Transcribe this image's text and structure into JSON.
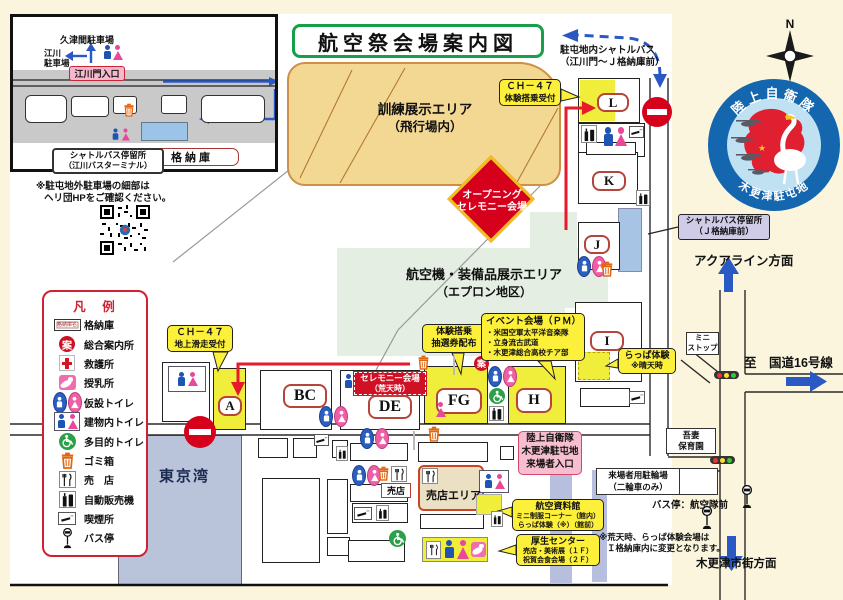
{
  "title": "航空祭会場案内図",
  "inset": {
    "title": "江川門周辺",
    "kutsuma_parking": "久津間駐車場",
    "egawa_parking_1": "江川",
    "egawa_parking_2": "駐車場",
    "gate_entrance": "江川門入口",
    "hangar_label": "格納庫",
    "shuttle_stop_1": "シャトルバス停留所",
    "shuttle_stop_2": "（江川バスターミナル）",
    "note_1": "※駐屯地外駐車場の細部は",
    "note_2": "ヘリ団HPをご確認ください。"
  },
  "compass": {
    "north": "N"
  },
  "emblem": {
    "top": "陸上自衛隊",
    "bottom": "木更津駐屯地"
  },
  "shuttle_note": {
    "line1": "駐屯地内シャトルバス",
    "line2": "（江川門～Ｊ格納庫前）"
  },
  "areas": {
    "training_1": "訓練展示エリア",
    "training_2": "（飛行場内）",
    "apron_1": "航空機・装備品展示エリア",
    "apron_2": "（エプロン地区）",
    "opening_1": "オープニング",
    "opening_2": "セレモニー会場",
    "tokyo_bay": "東京湾",
    "shop_area": "売店エリア",
    "shop_small": "売店"
  },
  "buildings": {
    "a": "A",
    "bc": "BC",
    "de": "DE",
    "fg": "FG",
    "h": "H",
    "i": "I",
    "j": "J",
    "k": "K",
    "l": "L"
  },
  "callouts": {
    "ch47_ride_1": "ＣＨ－４７",
    "ch47_ride_2": "体験搭乗受付",
    "ch47_taxi_1": "ＣＨ－４７",
    "ch47_taxi_2": "地上滑走受付",
    "lottery_1": "体験搭乗",
    "lottery_2": "抽選券配布",
    "event_title": "イベント会場（ＰＭ）",
    "event_1": "・米国空軍太平洋音楽隊",
    "event_2": "・立身流古武道",
    "event_3": "・木更津総合高校チア部",
    "ceremony_1": "セレモニー会場",
    "ceremony_2": "（荒天時）",
    "trumpet_1": "らっぱ体験",
    "trumpet_2": "※晴天時",
    "shuttle_j_1": "シャトルバス停留所",
    "shuttle_j_2": "（Ｊ格納庫前）",
    "museum_1": "航空資料館",
    "museum_2": "ミニ制服コーナー（館内）",
    "museum_3": "らっぱ体験（※）（館前）",
    "welfare_1": "厚生センター",
    "welfare_2": "売店・美術展（１Ｆ）",
    "welfare_3": "祝賀会食会場（２Ｆ）",
    "entrance_1": "陸上自衛隊",
    "entrance_2": "木更津駐屯地",
    "entrance_3": "来場者入口"
  },
  "directions": {
    "aqualine": "アクアライン方面",
    "route16": "至　国道16号線",
    "city": "木更津市街方面",
    "ministop_1": "ミニ",
    "ministop_2": "ストップ",
    "nursery_1": "吾妻",
    "nursery_2": "保育園",
    "bike_1": "来場者用駐輪場",
    "bike_2": "（二輪車のみ）",
    "busstop": "バス停：航空隊前",
    "rain_note_1": "※荒天時、らっぱ体験会場は",
    "rain_note_2": "Ｉ格納庫内に変更となります。"
  },
  "legend": {
    "title": "凡　例",
    "hangar_icon_text": "格納庫名",
    "info_glyph": "案",
    "items": [
      {
        "icon": "hangar-icon",
        "label": "格納庫"
      },
      {
        "icon": "info-icon",
        "label": "総合案内所"
      },
      {
        "icon": "first-aid-icon",
        "label": "救護所"
      },
      {
        "icon": "nursing-icon",
        "label": "授乳所"
      },
      {
        "icon": "temp-toilet-icon",
        "label": "仮設トイレ"
      },
      {
        "icon": "indoor-toilet-icon",
        "label": "建物内トイレ"
      },
      {
        "icon": "accessible-toilet-icon",
        "label": "多目的トイレ"
      },
      {
        "icon": "trash-icon",
        "label": "ゴミ箱"
      },
      {
        "icon": "shop-icon",
        "label": "売　店"
      },
      {
        "icon": "vending-icon",
        "label": "自動販売機"
      },
      {
        "icon": "smoking-icon",
        "label": "喫煙所"
      },
      {
        "icon": "bus-stop-icon",
        "label": "バス停"
      }
    ]
  },
  "colors": {
    "title_green": "#18a048",
    "callout_yellow": "#fdf03a",
    "no_entry_red": "#d6001c",
    "water_blue": "#b9c3da",
    "apron_green": "#e4eee2",
    "training_tan": "#f3d894",
    "route_red": "#e8192c",
    "arrow_blue": "#2b59c3",
    "emblem_blue": "#1466ae"
  }
}
